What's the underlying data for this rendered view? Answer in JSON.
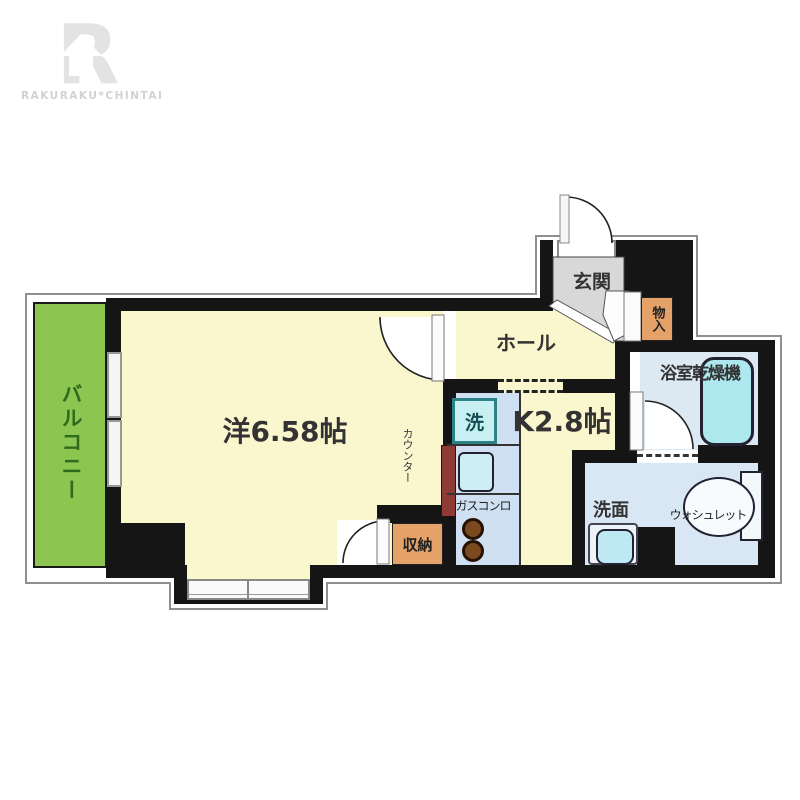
{
  "brand": {
    "logo_letter": "R",
    "logo_text": "RAKURAKU*CHINTAI"
  },
  "floorplan": {
    "balcony": "バルコニー",
    "western_room": "洋6.58帖",
    "counter": "カウンター",
    "closet": "収納",
    "hall": "ホール",
    "kitchen": "K2.8帖",
    "washer": "洗",
    "gas_stove": "ガスコンロ",
    "entrance": "玄関",
    "entry_storage": "物入",
    "bathroom_dryer": "浴室乾燥機",
    "washstand": "洗面",
    "washlet": "ウォシュレット"
  },
  "colors": {
    "wall": "#151515",
    "room_floor": "#faf6cd",
    "balcony_green": "#8cc550",
    "balcony_text": "#2f6b1d",
    "entrance_floor": "#d8d8d8",
    "storage_orange": "#e5a268",
    "counter_maroon": "#8f3a34",
    "kitchen_unit_blue": "#cfe0f2",
    "washroom_blue": "#d9e7f5",
    "bathroom_blue": "#dde9f2",
    "bathtub_cyan": "#ace8ee",
    "fixture_cyan": "#bfe9f2",
    "logo_gray": "#e3e3e3"
  }
}
